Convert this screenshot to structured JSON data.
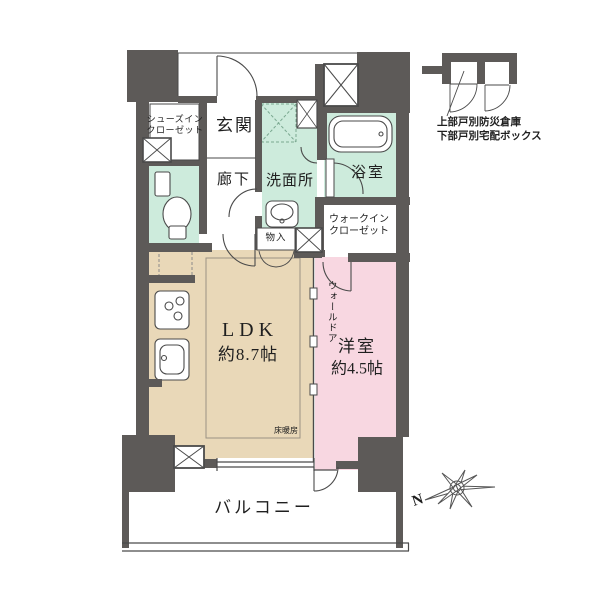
{
  "rooms": {
    "entrance": "玄関",
    "hallway": "廊下",
    "shoes_in_closet_l1": "シューズイン",
    "shoes_in_closet_l2": "クローゼット",
    "washroom": "洗面所",
    "bathroom": "浴室",
    "walk_in_closet_l1": "ウォークイン",
    "walk_in_closet_l2": "クローゼット",
    "storage": "物入",
    "ldk_name": "LDK",
    "ldk_size": "約8.7帖",
    "western_room_name": "洋室",
    "western_room_size": "約4.5帖",
    "balcony": "バルコニー"
  },
  "features": {
    "wall_door": "ウォールドア",
    "floor_heating": "床暖房"
  },
  "annotations": {
    "storage_note_l1": "上部戸別防災倉庫",
    "storage_note_l2": "下部戸別宅配ボックス",
    "compass_north": "N"
  },
  "icons": {
    "compass": "compass-rose-icon",
    "toilet": "toilet-icon",
    "bathtub": "bathtub-icon",
    "washbasin": "washbasin-icon",
    "stove": "stove-icon",
    "kitchen_sink": "kitchen-sink-icon",
    "duct_space": "hatched-box-icon"
  },
  "colors": {
    "wall": "#5d5a58",
    "wet_area": "#cdebdc",
    "living_area": "#e9d8b8",
    "bedroom_area": "#f8d7e1",
    "line": "#4a4a4a",
    "text": "#1f1f1f",
    "background": "#ffffff"
  }
}
